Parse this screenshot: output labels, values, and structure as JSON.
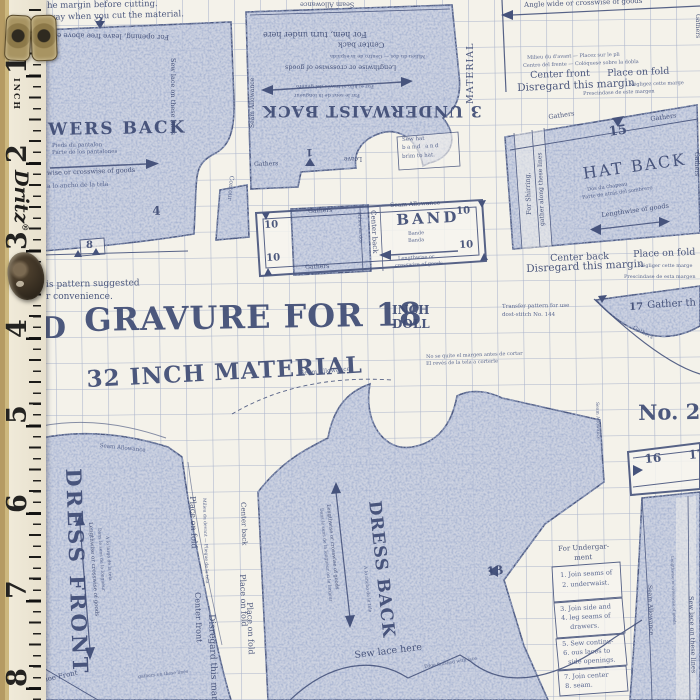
{
  "ruler": {
    "brand": "Dritz",
    "registered": "®",
    "unit_label": "INCH",
    "numbers": [
      "1",
      "2",
      "3",
      "4",
      "5",
      "6",
      "7",
      "8"
    ]
  },
  "top_notes": {
    "line1": "he margin before cutting.",
    "line2": "s way when you cut the material.",
    "opening_note": "For opening, leave free above edge",
    "crosswise_arrow": "Angle wide or crosswise of goods"
  },
  "headline": {
    "prefix": "D",
    "title": "GRAVURE FOR 18",
    "inch": "INCH",
    "doll": "DOLL",
    "material": "32 INCH MATERIAL",
    "suggested_line1": "is pattern suggested",
    "suggested_line2": "r convenience."
  },
  "drawers_back": {
    "title": "WERS BACK",
    "sub_fr": "Pieds du pantalon",
    "sub_es": "Parte de los pantalones",
    "grain": "wise or crosswise of goods",
    "grain_es": "a lo ancho de la tela",
    "sew_lace": "Sew lace on these lines",
    "corner": "Contour"
  },
  "underwaist": {
    "title": "3 UNDERWAIST BACK",
    "seam_allowance": "Seam Allowance",
    "hem_note": "For hem, turn under here",
    "center_back": "Center back",
    "center_back_intl": "Milieu du dos — Centro de la espalda",
    "grain": "Lengthwise or crosswise of goods",
    "grain_es": "Por el hilo al través del género",
    "grain_fr": "Par le sens de la longueur",
    "gathers": "Gathers",
    "leave": "Leave",
    "hat_note": [
      "Sew hat",
      "band and",
      "brim to hat."
    ]
  },
  "fold_block_top": {
    "intl1": "Milieu du d'avant — Placez sur le pli",
    "intl2": "Centro del frente — Colóquese sobre la dobla",
    "center_front": "Center front",
    "place_on_fold": "Place on fold",
    "disregard": "Disregard this margin",
    "fr": "Négligez cette marge",
    "es": "Prescindase de este margen",
    "material_vertical": "MATERIAL",
    "gathers_vertical": "Gathers"
  },
  "hat_back": {
    "title": "HAT BACK",
    "gathers": "Gathers",
    "num": "15",
    "fr": "Dos du chapeau",
    "es": "Parte de atrás del sombrero",
    "grain": "Lengthwise of goods",
    "shirring1": "For Shirring,",
    "shirring2": "gather along these lines"
  },
  "band": {
    "title": "BAND",
    "num": "10",
    "gathers": "Gathers",
    "seam_allowance": "Seam Allowance",
    "fr": "Bande",
    "es": "Banda",
    "center_back": "Center back",
    "center_back_fr": "Milieu du dos",
    "grain1": "Lengthwise or",
    "grain2": "crosswise of goods"
  },
  "fold_block_mid": {
    "center_back": "Center back",
    "place_on_fold": "Place on fold",
    "disregard": "Disregard this margin",
    "fr": "Négliger cette marge",
    "es": "Prescindase de esta margen"
  },
  "transfer_note": {
    "line1": "Transfer pattern for use",
    "line2": "dost-stitch No. 144"
  },
  "margin_note_es": {
    "line1": "No se quite el margen antes de cortar",
    "line2": "El revés de la tela a corterle"
  },
  "gather_17": {
    "num": "17",
    "label": "Gather th",
    "curve": "Gathers"
  },
  "no2": {
    "label": "No. 2",
    "n16": "16",
    "n17": "17",
    "seam_vertical": "Seam Allowance"
  },
  "dress_front": {
    "title": "DRESS FRONT",
    "grain": "Lengthwise or crosswise of goods",
    "grain_fr": "Dans le sens de la longueur",
    "grain_es": "A lo largo de la tela",
    "place_on_fold": "Place on fold",
    "fold_intl": "Milieu du devant — Pliegue de la tela",
    "center_front": "Center front",
    "disregard": "Disregard this margin",
    "shoe": "Shoe Front",
    "seam_curve": "Seam Allowance"
  },
  "dress_back": {
    "title": "DRESS BACK",
    "grain": "Lengthwise or crosswise of goods",
    "grain_fr": "Dans le sens de la longueur ou la largeur",
    "grain_es": "A lo ancho de la tela",
    "center_back": "Center back",
    "place_on_fold": "Place on fold",
    "num13": "13",
    "sew_lace": "Sew lace here",
    "lace_note": "Edge finished with lace",
    "gather_note": "gathers on these lines",
    "seam_curve": "Seam Allowance"
  },
  "right_column": {
    "seam_allowance": "Seam Allowance",
    "sew_lace": "Sew lace on these lines",
    "grain_small": "Lengthwise or crosswise of goods"
  },
  "instructions": {
    "heading1": "For Undergar-",
    "heading2": "ment",
    "steps": [
      [
        "1. Join seams of",
        "2. underwaist."
      ],
      [
        "3. Join side and",
        "4. leg seams of",
        "drawers."
      ],
      [
        "5. Sew continu-",
        "6. ous laces to",
        "side openings."
      ],
      [
        "7. Join center",
        "8. seam."
      ]
    ]
  },
  "piece_numbers": {
    "n1": "1",
    "n3": "3",
    "n4": "4",
    "n8": "8"
  },
  "colors": {
    "print_blue": "#3d4a72",
    "grid_blue": "#8d9cc0",
    "fabric_cream": "#f4f2ea",
    "ruler_cream": "#ece7d8"
  }
}
